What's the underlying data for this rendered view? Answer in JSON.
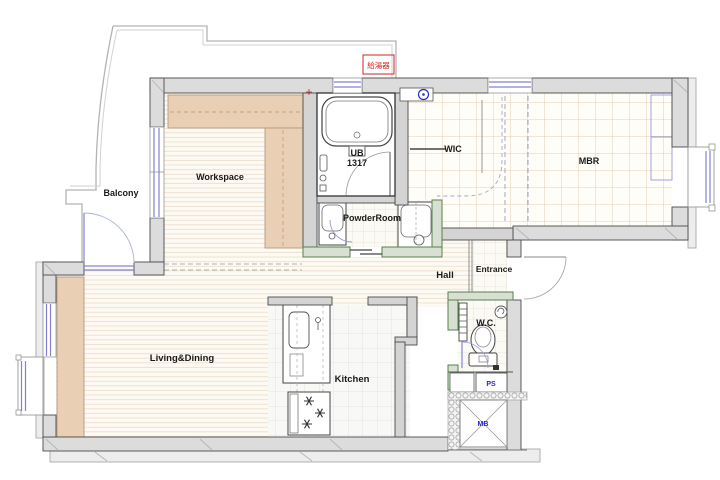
{
  "rooms": {
    "balcony": "Balcony",
    "workspace": "Workspace",
    "unit_bath": "UB",
    "unit_bath_size": "1317",
    "powder_room": "PowderRoom",
    "wic": "WIC",
    "master_bedroom": "MBR",
    "hall": "Hall",
    "entrance": "Entrance",
    "wc": "W.C.",
    "living_dining": "Living&Dining",
    "kitchen": "Kitchen"
  },
  "service_labels": {
    "pipe_space": "PS",
    "meter_box": "MB",
    "water_heater": "給湯器"
  },
  "colors": {
    "counter_accent": "#e9cfb4",
    "wet_area_wall_green": "#56804d",
    "window_blue": "#8282d0",
    "water_heater_red": "#d42222",
    "service_label_blue": "#2424d8",
    "wall_gray": "#dcdcdc"
  }
}
